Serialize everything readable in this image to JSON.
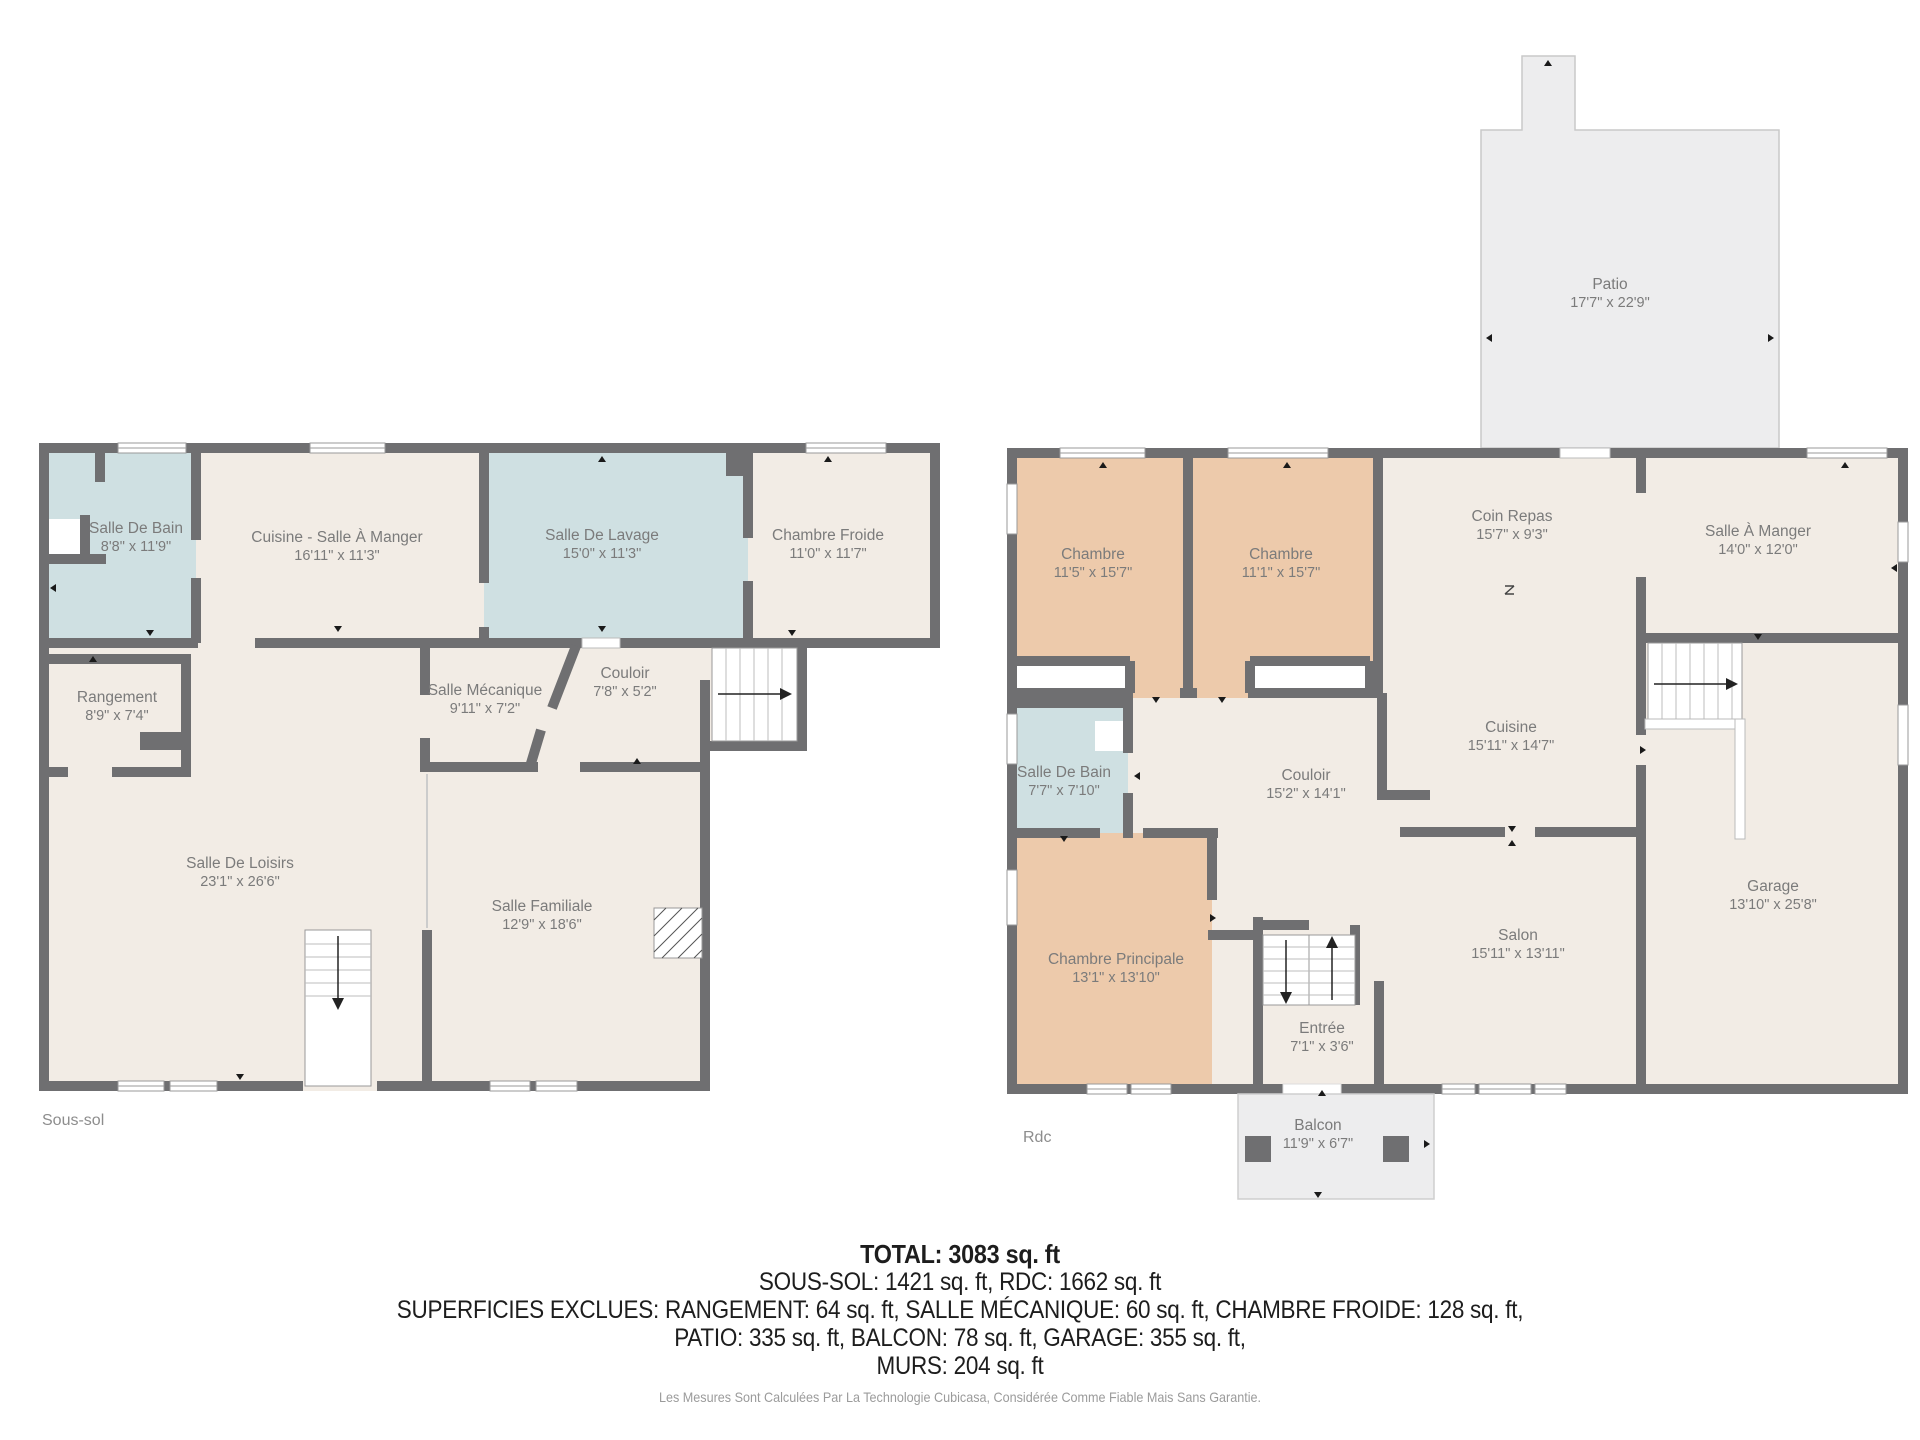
{
  "floors": [
    {
      "label": "Sous-sol",
      "rooms": [
        {
          "name": "Salle De Bain",
          "dims": "8'8\" x 11'9\""
        },
        {
          "name": "Cuisine - Salle À Manger",
          "dims": "16'11\" x 11'3\""
        },
        {
          "name": "Salle De Lavage",
          "dims": "15'0\" x 11'3\""
        },
        {
          "name": "Chambre Froide",
          "dims": "11'0\" x 11'7\""
        },
        {
          "name": "Rangement",
          "dims": "8'9\" x 7'4\""
        },
        {
          "name": "Salle Mécanique",
          "dims": "9'11\" x 7'2\""
        },
        {
          "name": "Couloir",
          "dims": "7'8\" x 5'2\""
        },
        {
          "name": "Salle De Loisirs",
          "dims": "23'1\" x 26'6\""
        },
        {
          "name": "Salle Familiale",
          "dims": "12'9\" x 18'6\""
        }
      ]
    },
    {
      "label": "Rdc",
      "rooms": [
        {
          "name": "Patio",
          "dims": "17'7\" x 22'9\""
        },
        {
          "name": "Chambre",
          "dims": "11'5\" x 15'7\""
        },
        {
          "name": "Chambre",
          "dims": "11'1\" x 15'7\""
        },
        {
          "name": "Coin Repas",
          "dims": "15'7\" x 9'3\""
        },
        {
          "name": "Salle À Manger",
          "dims": "14'0\" x 12'0\""
        },
        {
          "name": "Salle De Bain",
          "dims": "7'7\" x 7'10\""
        },
        {
          "name": "Couloir",
          "dims": "15'2\" x 14'1\""
        },
        {
          "name": "Cuisine",
          "dims": "15'11\" x 14'7\""
        },
        {
          "name": "Chambre Principale",
          "dims": "13'1\" x 13'10\""
        },
        {
          "name": "Salon",
          "dims": "15'11\" x 13'11\""
        },
        {
          "name": "Garage",
          "dims": "13'10\" x 25'8\""
        },
        {
          "name": "Entrée",
          "dims": "7'1\" x 3'6\""
        },
        {
          "name": "Balcon",
          "dims": "11'9\" x 6'7\""
        }
      ]
    }
  ],
  "summary": {
    "total": "TOTAL: 3083 sq. ft",
    "line2": "SOUS-SOL: 1421 sq. ft, RDC: 1662 sq. ft",
    "line3": "SUPERFICIES EXCLUES: RANGEMENT: 64 sq. ft, SALLE MÉCANIQUE: 60 sq. ft, CHAMBRE FROIDE: 128 sq. ft,",
    "line4": "PATIO: 335 sq. ft, BALCON: 78 sq. ft, GARAGE: 355 sq. ft,",
    "line5": "MURS: 204 sq. ft",
    "disclaimer": "Les Mesures Sont Calculées Par La Technologie Cubicasa, Considérée Comme Fiable Mais Sans Garantie."
  },
  "colors": {
    "wall": "#6f6f71",
    "room_default": "#f2ece5",
    "room_wet": "#cfe0e2",
    "room_bedroom": "#edcaab",
    "outdoor": "#ededee",
    "label_text": "#7b7b7b"
  }
}
